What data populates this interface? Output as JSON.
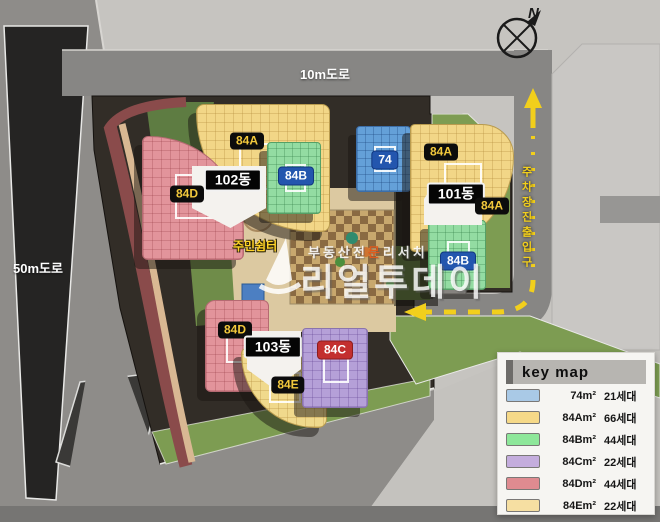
{
  "compass": {
    "north_label": "N"
  },
  "roads": {
    "top_label": "10m도로",
    "left_label": "50m도로",
    "parking_label": "주차장진출입구"
  },
  "site": {
    "rest_area_label": "주민쉼터"
  },
  "buildings": {
    "b84a_top": "84A",
    "b84d_top": "84D",
    "b84b_top": "84B",
    "core_102": "102동",
    "b74": "74",
    "b84a_right_upper": "84A",
    "core_101": "101동",
    "b84a_right_lower": "84A",
    "b84b_right": "84B",
    "b84d_bottom": "84D",
    "core_103": "103동",
    "b84c": "84C",
    "b84e": "84E"
  },
  "legend": {
    "title": "key map",
    "rows": [
      {
        "color": "#a9c9e6",
        "area": "74m²",
        "households": "21세대"
      },
      {
        "color": "#f6d988",
        "area": "84Am²",
        "households": "66세대"
      },
      {
        "color": "#8ee79a",
        "area": "84Bm²",
        "households": "44세대"
      },
      {
        "color": "#c4addd",
        "area": "84Cm²",
        "households": "22세대"
      },
      {
        "color": "#df8b90",
        "area": "84Dm²",
        "households": "44세대"
      },
      {
        "color": "#f6dfa2",
        "area": "84Em²",
        "households": "22세대"
      }
    ]
  },
  "watermark": {
    "small_pre": "부동산전",
    "small_highlight": "문",
    "small_post": "리서치",
    "brand": "리얼투데이"
  },
  "colors": {
    "unit_74": "#64a0d8",
    "unit_84a": "#f2d687",
    "unit_84b": "#93dca2",
    "unit_84c": "#b5a0d8",
    "unit_84d": "#e2949b",
    "unit_84e": "#f0d98c",
    "road_dash_yellow": "#f2cf1c"
  }
}
